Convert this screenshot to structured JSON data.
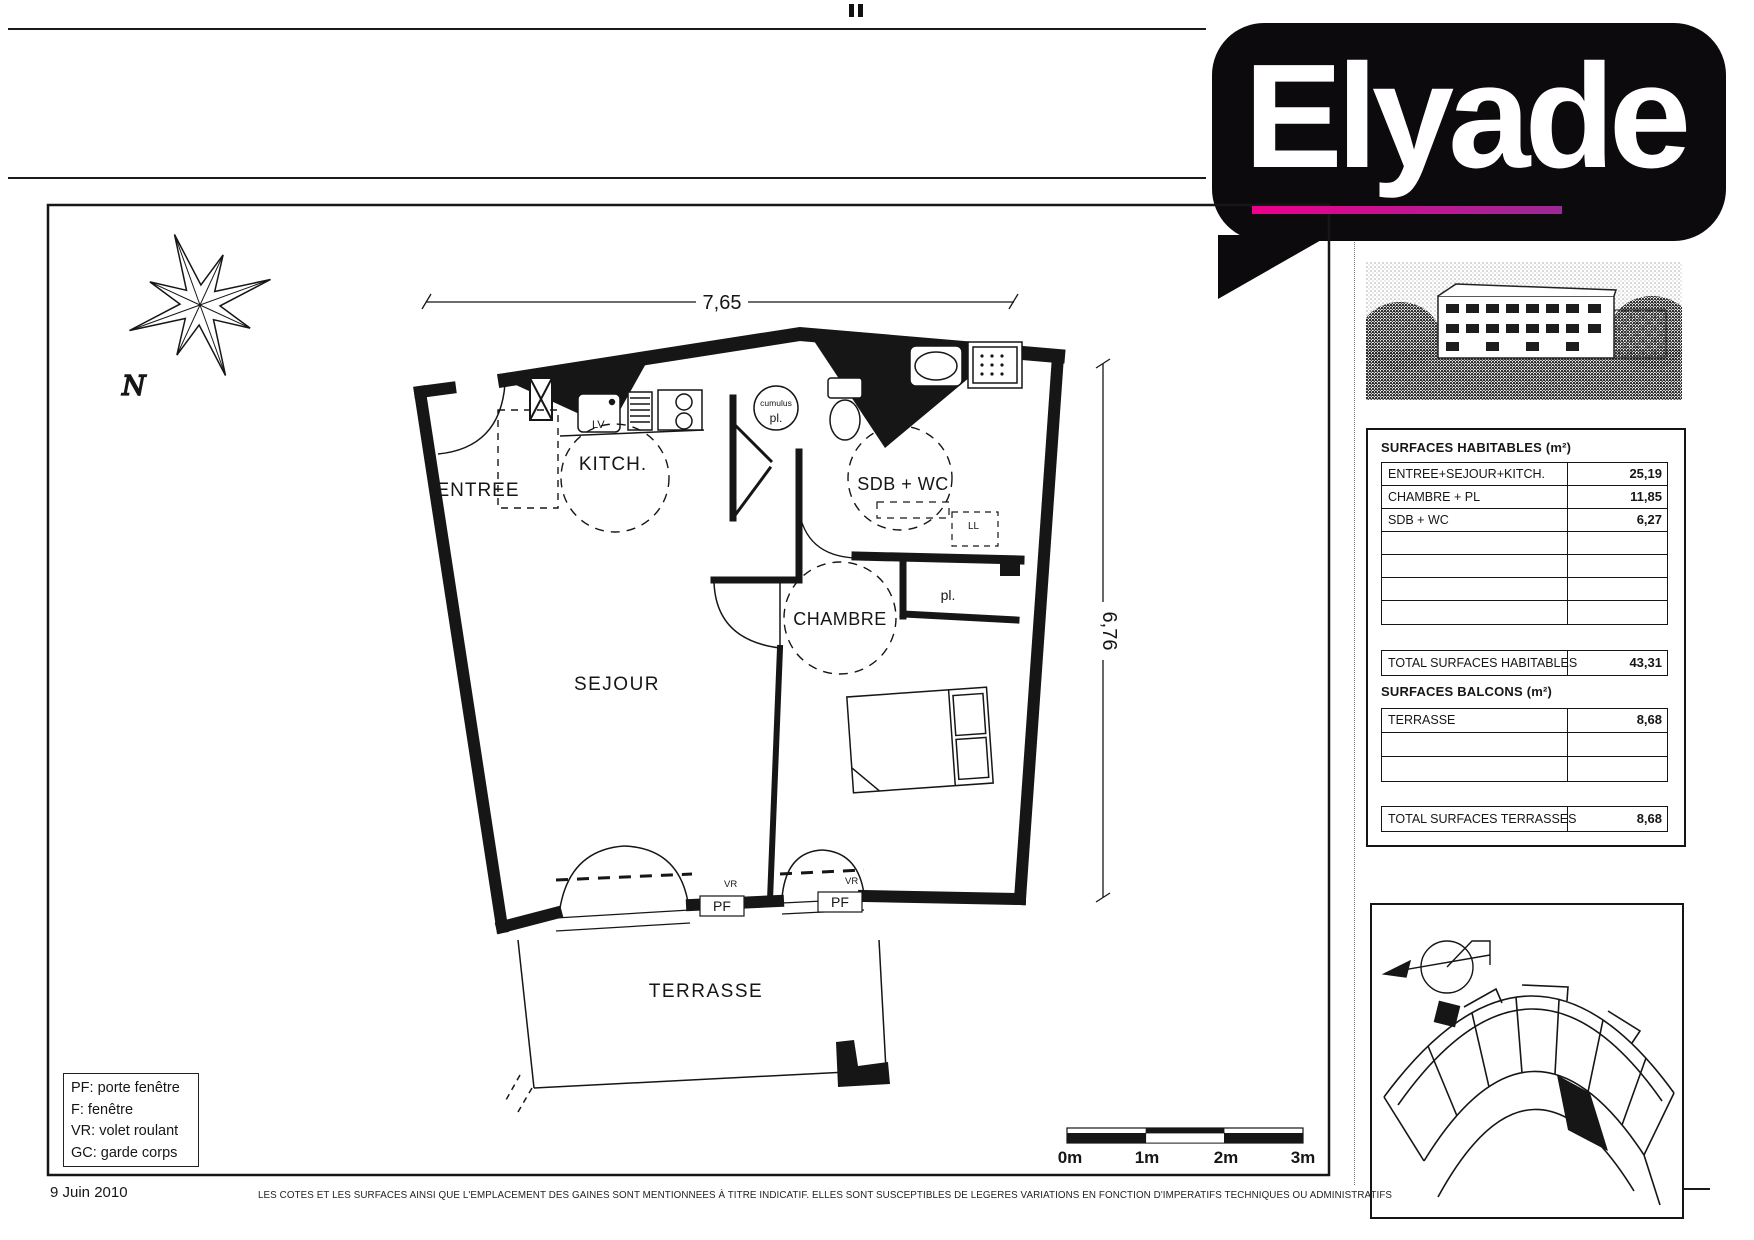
{
  "logo": {
    "brand": "Elyade"
  },
  "floorplan": {
    "dim_top": "7,65",
    "dim_right": "6,76",
    "rooms": {
      "entree": "ENTREE",
      "kitchen": "KITCH.",
      "sdb": "SDB + WC",
      "chambre": "CHAMBRE",
      "sejour": "SEJOUR",
      "terrasse": "TERRASSE",
      "placard": "pl."
    },
    "labels": {
      "north": "N",
      "lv": "LV",
      "cumulus": "cumulus",
      "cumulus_pl": "pl.",
      "ll": "LL",
      "vr_left": "VR",
      "vr_right": "VR",
      "pf_left": "PF",
      "pf_right": "PF"
    }
  },
  "legend": {
    "lines": [
      "PF: porte fenêtre",
      "F: fenêtre",
      "VR: volet roulant",
      "GC: garde corps"
    ]
  },
  "scalebar": {
    "labels": [
      "0m",
      "1m",
      "2m",
      "3m"
    ]
  },
  "surfaces": {
    "habitables": {
      "title": "SURFACES HABITABLES (m²)",
      "rows": [
        {
          "label": "ENTREE+SEJOUR+KITCH.",
          "value": "25,19"
        },
        {
          "label": "CHAMBRE + PL",
          "value": "11,85"
        },
        {
          "label": "SDB + WC",
          "value": "6,27"
        }
      ],
      "total_label": "TOTAL SURFACES HABITABLES",
      "total_value": "43,31"
    },
    "balcons": {
      "title": "SURFACES BALCONS (m²)",
      "rows": [
        {
          "label": "TERRASSE",
          "value": "8,68"
        }
      ],
      "total_label": "TOTAL SURFACES TERRASSES",
      "total_value": "8,68"
    }
  },
  "footer": {
    "date": "9 Juin 2010",
    "disclaimer": "LES COTES ET LES SURFACES AINSI QUE L'EMPLACEMENT DES GAINES SONT MENTIONNEES À TITRE INDICATIF. ELLES SONT SUSCEPTIBLES DE LEGERES VARIATIONS EN FONCTION D'IMPERATIFS TECHNIQUES OU ADMINISTRATIFS"
  }
}
